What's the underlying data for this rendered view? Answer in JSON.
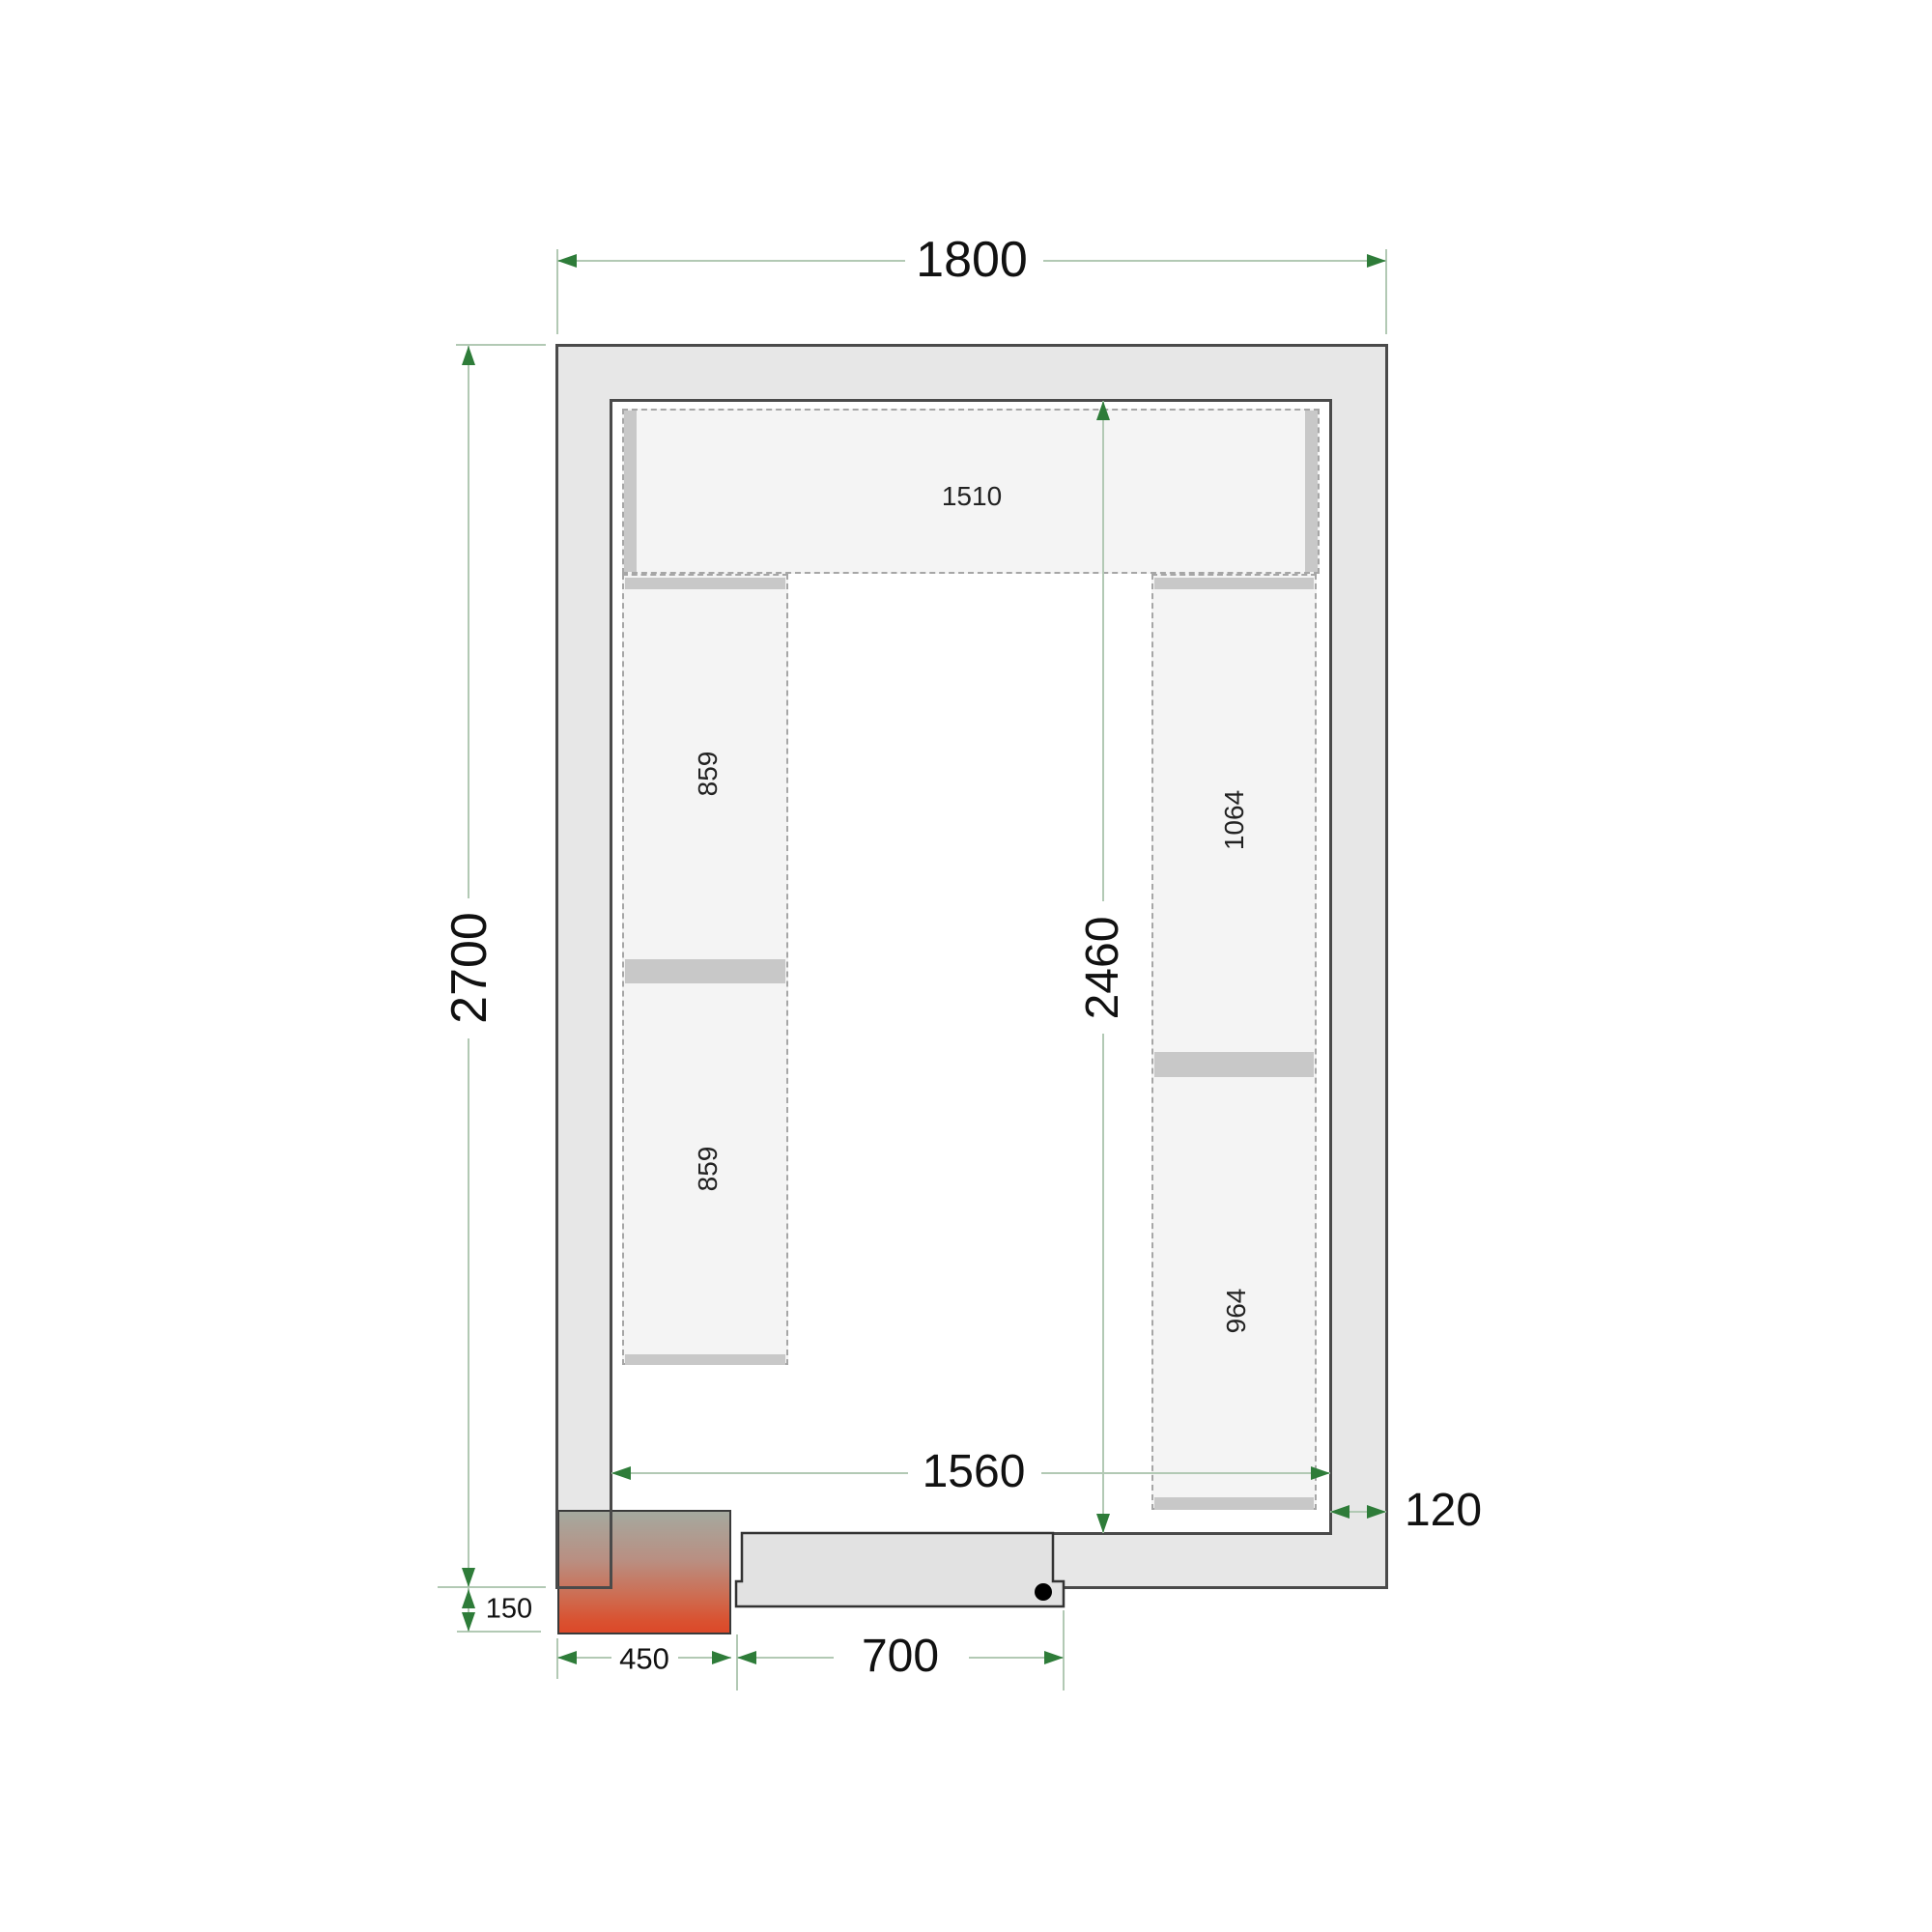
{
  "drawing": {
    "type": "cold-room-floor-plan",
    "dimensions": {
      "overall_width": {
        "value": "1800"
      },
      "overall_height": {
        "value": "2700"
      },
      "inner_width": {
        "value": "1560"
      },
      "inner_height": {
        "value": "2460"
      },
      "wall_thickness": {
        "value": "120"
      },
      "door_width": {
        "value": "700"
      },
      "unit_width": {
        "value": "450"
      },
      "unit_offset": {
        "value": "150"
      }
    },
    "shelves": {
      "top": {
        "value": "1510"
      },
      "left_upper": {
        "value": "859"
      },
      "left_lower": {
        "value": "859"
      },
      "right_upper": {
        "value": "1064"
      },
      "right_lower": {
        "value": "964"
      }
    },
    "colors": {
      "dimension_arrow_green": "#2e7c39",
      "dimension_line_green": "#b2c9b4",
      "wall_fill": "#e7e7e7",
      "outline": "#4a4a4a",
      "shelf_fill": "#f4f4f4",
      "shelf_bracket": "#c8c8c8",
      "unit_gradient_top": "#a5a99f",
      "unit_gradient_bottom": "#dc4829",
      "hinge_dot": "#000000"
    }
  }
}
